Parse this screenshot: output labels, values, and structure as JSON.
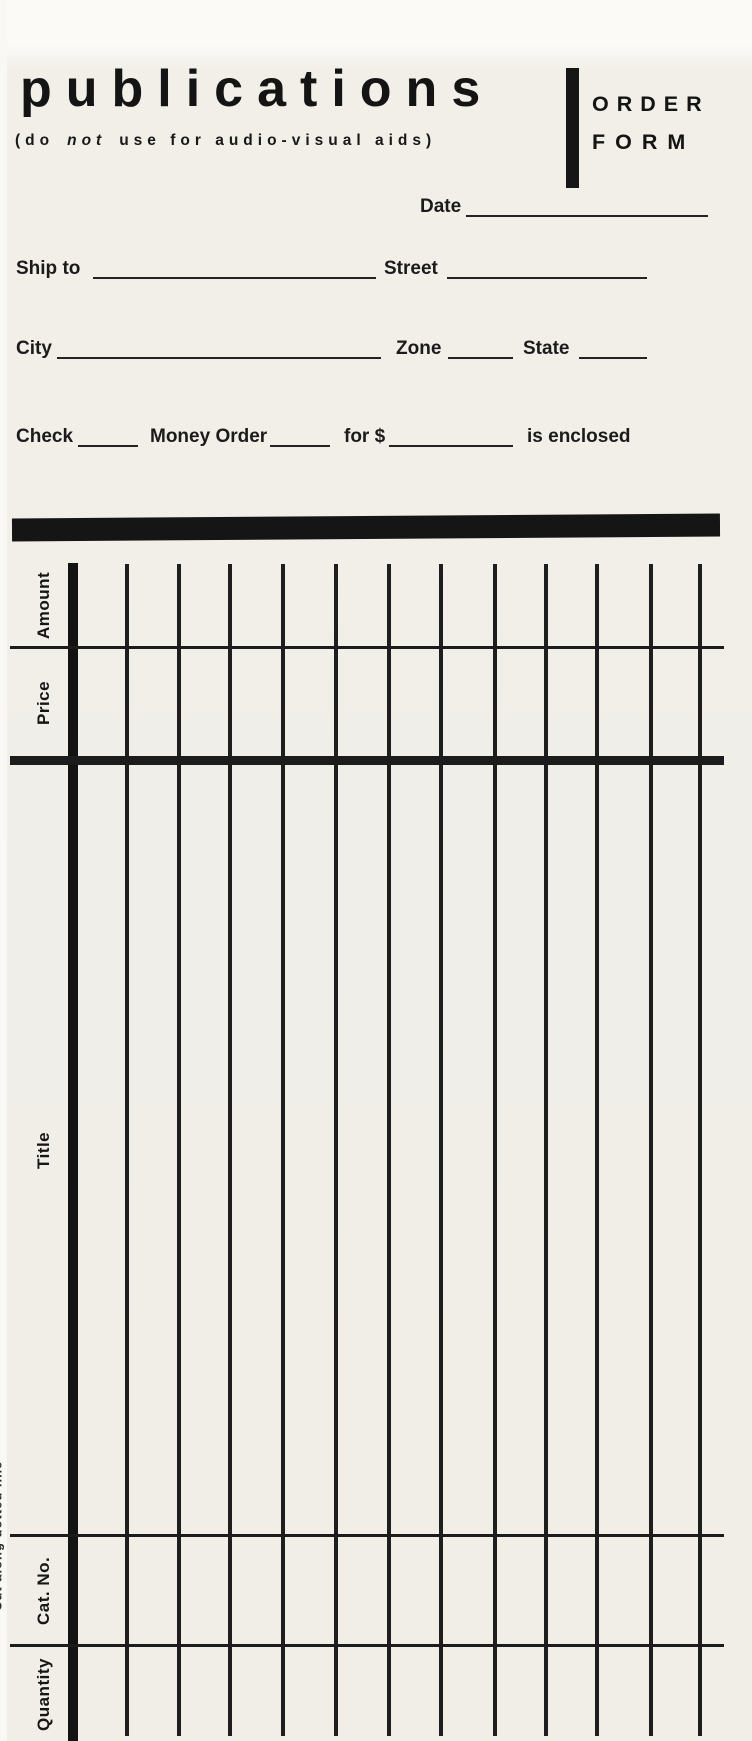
{
  "header": {
    "title": "publications",
    "subtitle_open": "(do",
    "subtitle_emph": "not",
    "subtitle_rest": "use for audio-visual aids)",
    "badge_line1": "ORDER",
    "badge_line2": "FORM"
  },
  "fields": {
    "date": "Date",
    "ship_to": "Ship to",
    "street": "Street",
    "city": "City",
    "zone": "Zone",
    "state": "State",
    "check": "Check",
    "money_order": "Money Order",
    "for_dollar": "for $",
    "is_enclosed": "is enclosed"
  },
  "table": {
    "headers": [
      "Amount",
      "Price",
      "Title",
      "Cat. No.",
      "Quantity"
    ],
    "blank_entry_columns": 12
  },
  "edge_note": "Cut along dotted line",
  "colors": {
    "paper": "#f1efe8",
    "ink": "#1a1a1a"
  }
}
